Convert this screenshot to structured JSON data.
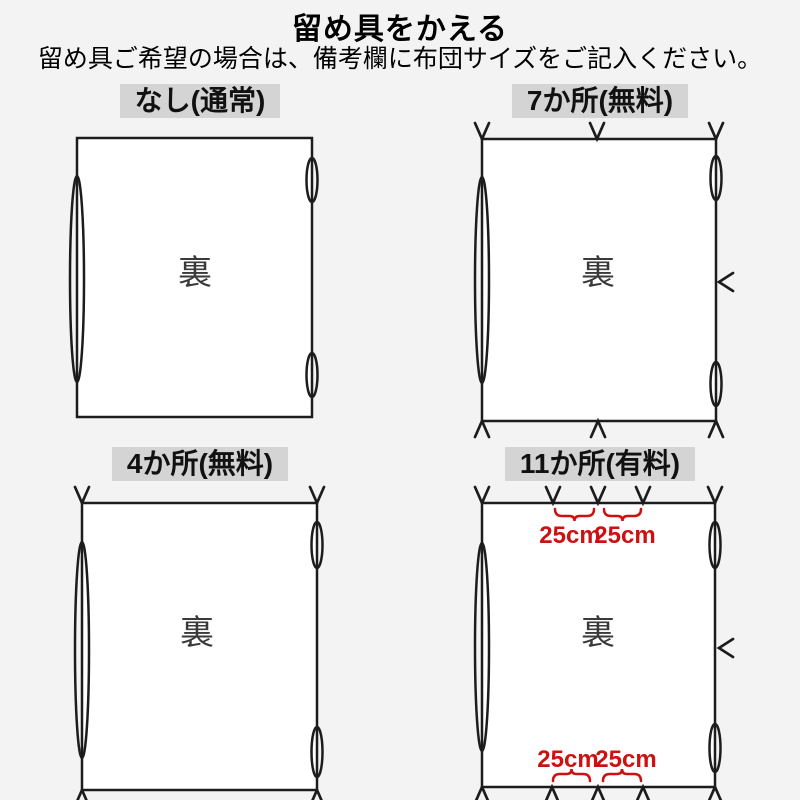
{
  "header": {
    "title": "留め具をかえる",
    "subtitle": "留め具ご希望の場合は、備考欄に布団サイズをご記入ください。"
  },
  "colors": {
    "background": "#f3f3f3",
    "ink": "#1c1c1c",
    "accent_red": "#cc1111",
    "label_bg": "#d4d4d4",
    "back_ink": "#3a3a3a"
  },
  "panels": [
    {
      "label": "なし(通常)",
      "back_label": "裏"
    },
    {
      "label": "7か所(無料)",
      "back_label": "裏"
    },
    {
      "label": "4か所(無料)",
      "back_label": "裏"
    },
    {
      "label": "11か所(有料)",
      "back_label": "裏",
      "dim_labels": {
        "top": [
          "25cm",
          "25cm"
        ],
        "bottom": [
          "25cm",
          "25cm"
        ]
      }
    }
  ]
}
